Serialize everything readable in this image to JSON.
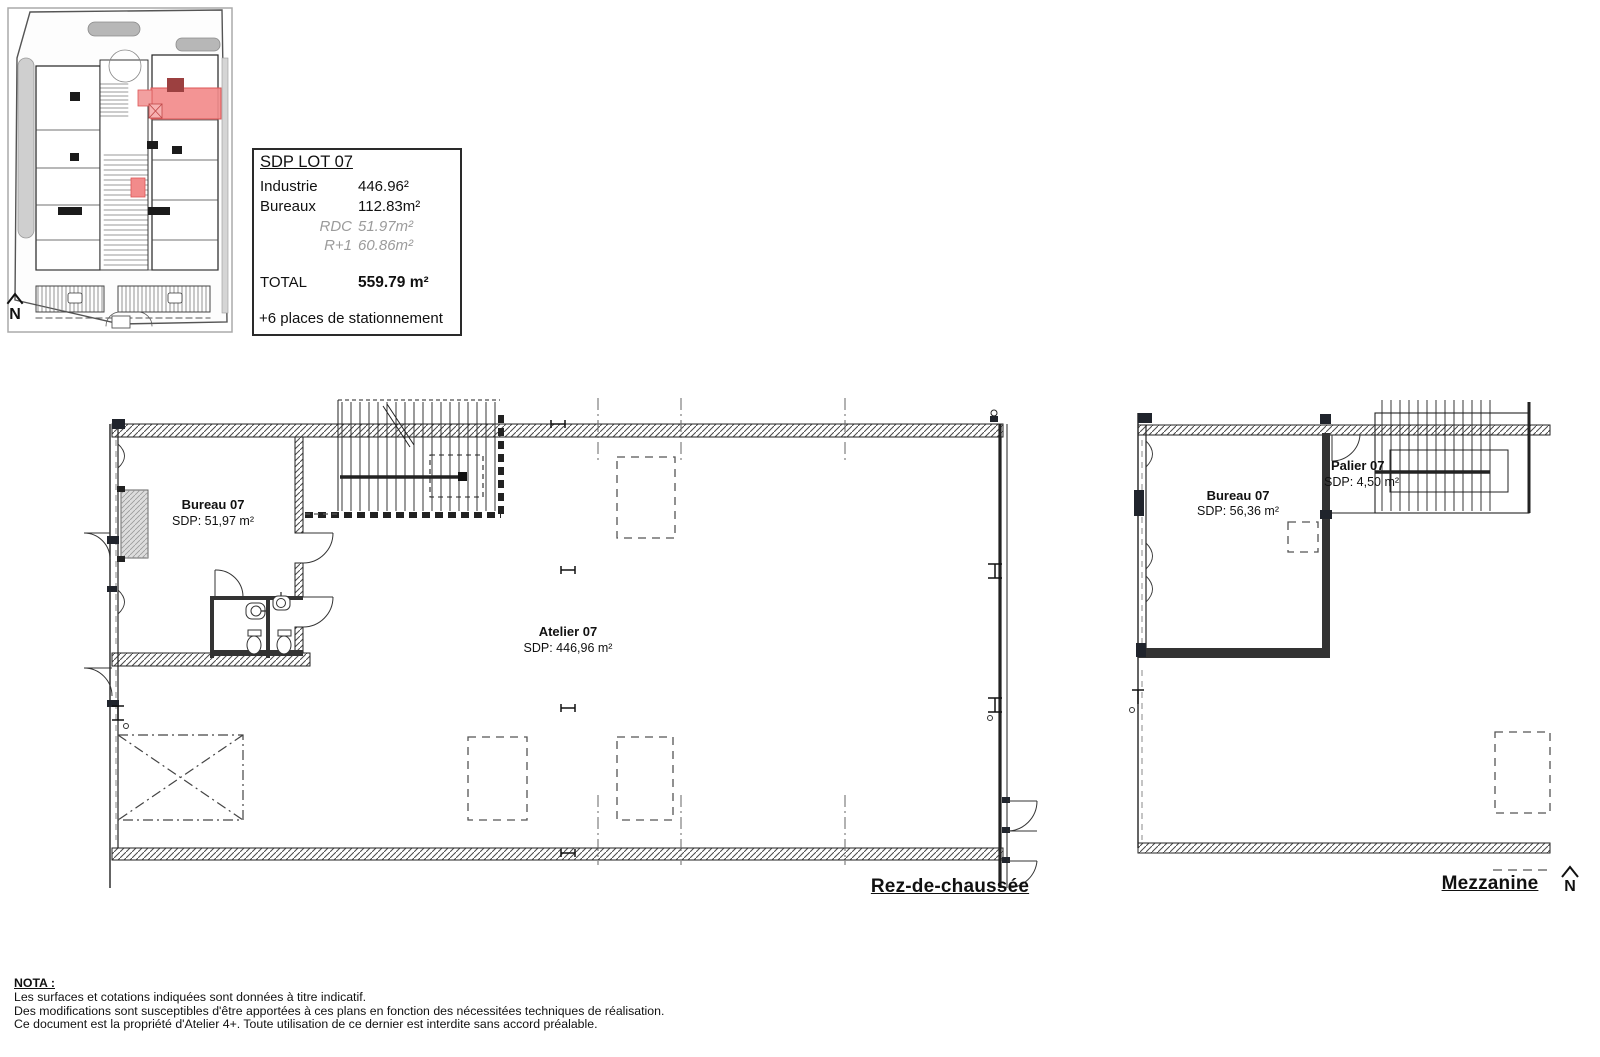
{
  "colors": {
    "highlight_fill": "#F28B8B",
    "highlight_stroke": "#DD5555",
    "line": "#1A1A1A",
    "muted_text": "#9B9B9B",
    "site_gray": "#BDBDBD"
  },
  "site_plan": {
    "north_label": "N"
  },
  "title_block": {
    "title": "SDP LOT 07",
    "rows": [
      {
        "label": "Industrie",
        "value": "446.96²"
      },
      {
        "label": "Bureaux",
        "value": "112.83m²"
      },
      {
        "label": "RDC",
        "value": "51.97m²"
      },
      {
        "label": "R+1",
        "value": "60.86m²"
      }
    ],
    "total_label": "TOTAL",
    "total_value": "559.79 m²",
    "parking_note": "+6 places de stationnement"
  },
  "rdc_plan": {
    "title": "Rez-de-chaussée",
    "rooms": [
      {
        "name": "Bureau 07",
        "area": "SDP: 51,97 m²"
      },
      {
        "name": "Atelier 07",
        "area": "SDP: 446,96 m²"
      }
    ]
  },
  "mezzanine_plan": {
    "title": "Mezzanine",
    "north_label": "N",
    "rooms": [
      {
        "name": "Bureau 07",
        "area": "SDP: 56,36 m²"
      },
      {
        "name": "Palier 07",
        "area": "SDP: 4,50 m²"
      }
    ]
  },
  "nota": {
    "heading": "NOTA :",
    "lines": [
      "Les surfaces et cotations indiquées sont données à titre indicatif.",
      "Des modifications sont susceptibles d'être apportées à ces plans en fonction des nécessitées techniques de réalisation.",
      "Ce document est la propriété d'Atelier 4+. Toute utilisation de ce dernier est interdite sans accord préalable."
    ]
  }
}
